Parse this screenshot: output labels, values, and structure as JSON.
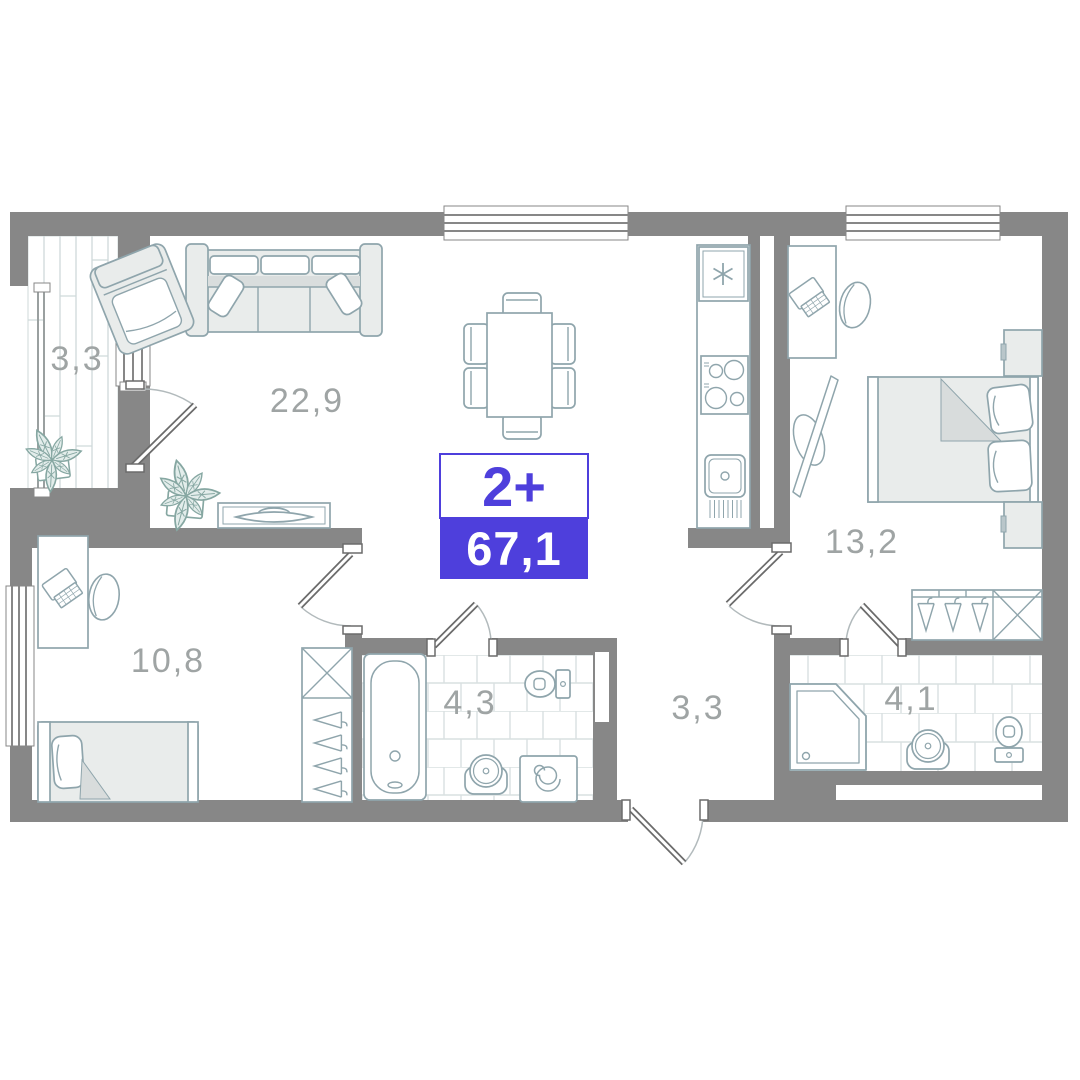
{
  "floor_plan": {
    "badge": {
      "layout": "2+",
      "total_area": "67,1"
    },
    "rooms": {
      "balcony": {
        "area": "3,3"
      },
      "living_kitchen": {
        "area": "22,9"
      },
      "bedroom": {
        "area": "13,2"
      },
      "room_second": {
        "area": "10,8"
      },
      "bathroom": {
        "area": "4,3"
      },
      "hallway": {
        "area": "3,3"
      },
      "ensuite_bathroom": {
        "area": "4,1"
      }
    },
    "colors": {
      "wall": "#878787",
      "accent": "#4e3fdc",
      "furniture_line": "#8fa5ac",
      "room_label": "#9fa4a4"
    }
  }
}
